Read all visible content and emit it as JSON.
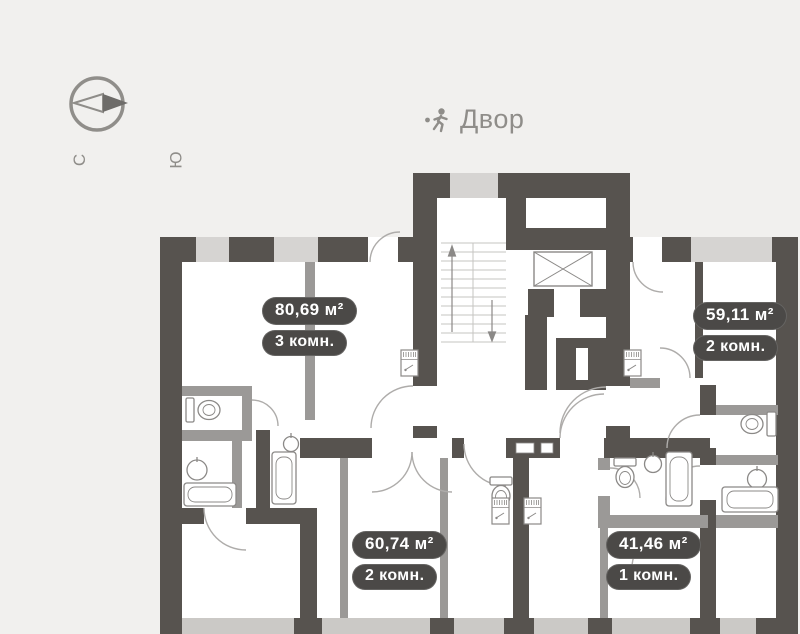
{
  "palette": {
    "background": "#f1f0ee",
    "wall_dark": "#57534f",
    "wall_window_light": "#d6d4d2",
    "wall_partition": "#9b9997",
    "badge_background": "#4b4947",
    "badge_text": "#ffffff",
    "muted_text": "#8f8d89"
  },
  "compass": {
    "north_label": "С",
    "south_label": "Ю",
    "icon": "compass-icon"
  },
  "courtyard": {
    "label": "Двор",
    "icon": "running-person-icon"
  },
  "badges": [
    {
      "area": "80,69 м²",
      "rooms": "3 комн."
    },
    {
      "area": "59,11 м²",
      "rooms": "2 комн."
    },
    {
      "area": "60,74 м²",
      "rooms": "2 комн."
    },
    {
      "area": "41,46 м²",
      "rooms": "1 комн."
    }
  ],
  "icons": {
    "compass": "compass-icon",
    "courtyard_person": "running-person-icon",
    "stairs": "stairs-icon",
    "elevator": "elevator-shaft-icon",
    "toilet": "toilet-icon",
    "sink": "sink-icon",
    "bathtub": "bathtub-icon",
    "electrical_panel": "electrical-panel-icon",
    "door": "door-arc"
  }
}
